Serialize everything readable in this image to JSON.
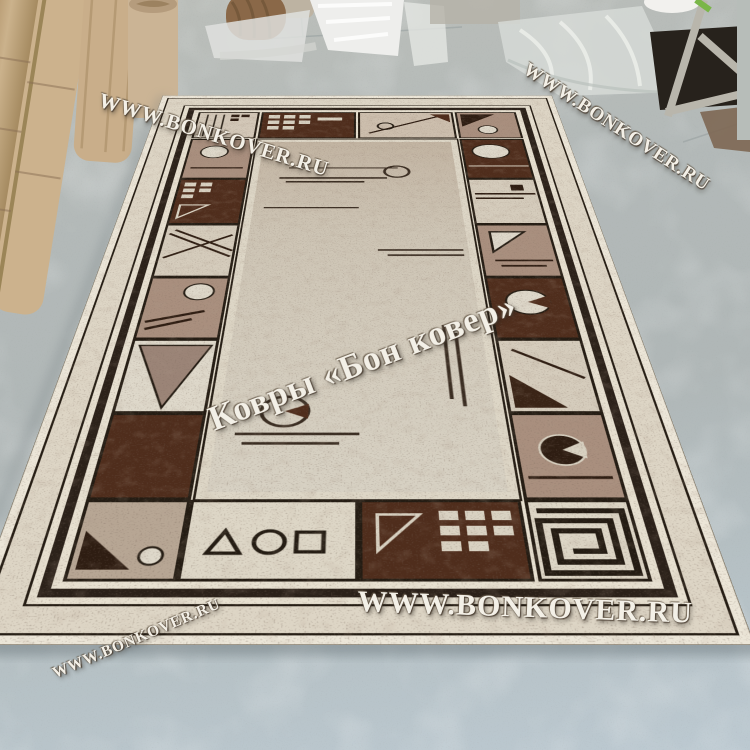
{
  "scene": {
    "description": "Showroom photograph of a beige-brown geometric rug laid in perspective on a gray concrete floor, rolled carpets and plastic-wrapped rolls in the background",
    "floor_color": "#b3b9b8",
    "rug_palette": {
      "cream": "#e7e0d0",
      "field": "#cfc7b8",
      "taupe": "#a98f7e",
      "light_panel": "#d5ccbc",
      "dark_brown": "#4f2d1c",
      "outline": "#241c13"
    }
  },
  "watermarks": [
    {
      "id": "top-left",
      "text": "WWW.BONKOVER.RU"
    },
    {
      "id": "top-right",
      "text": "WWW.BONKOVER.RU"
    },
    {
      "id": "center",
      "text": "Ковры «Бон ковер»"
    },
    {
      "id": "bottom",
      "text": "WWW.BONKOVER.RU"
    },
    {
      "id": "bottom-left",
      "text": "WWW.BONKOVER.RU"
    }
  ]
}
